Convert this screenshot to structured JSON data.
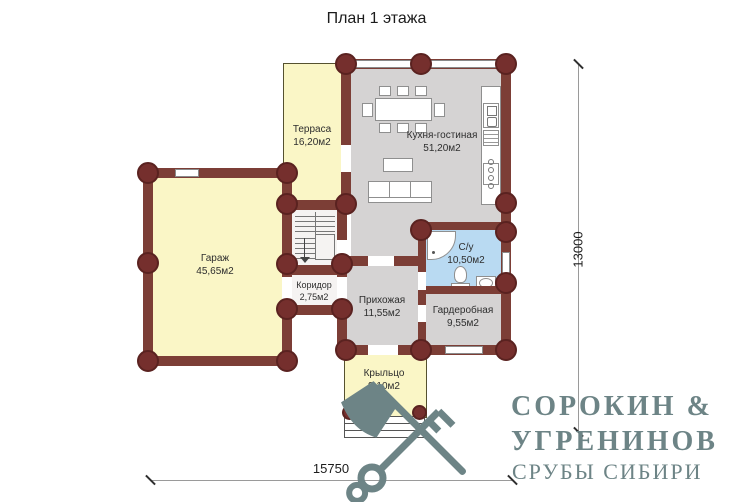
{
  "title": "План 1 этажа",
  "rooms": [
    {
      "name": "Терраса",
      "area": "16,20м2"
    },
    {
      "name": "Кухня-гостиная",
      "area": "51,20м2"
    },
    {
      "name": "Гараж",
      "area": "45,65м2"
    },
    {
      "name": "Коридор",
      "area": "2,75м2"
    },
    {
      "name": "Прихожая",
      "area": "11,55м2"
    },
    {
      "name": "С/у",
      "area": "10,50м2"
    },
    {
      "name": "Гардеробная",
      "area": "9,55м2"
    },
    {
      "name": "Крыльцо",
      "area": "9,10м2"
    }
  ],
  "dimensions": {
    "width": "15750",
    "height": "13000"
  },
  "logo": {
    "line1": "СОРОКИН &",
    "line2": "УГРЕНИНОВ",
    "line3": "СРУБЫ СИБИРИ"
  },
  "colors": {
    "wall": "#7c3e36",
    "log": "#752f2d",
    "room_yellow": "#faf6c6",
    "room_gray": "#d5d3d3",
    "room_blue": "#b9daf2",
    "logo_teal": "#6d8486"
  }
}
